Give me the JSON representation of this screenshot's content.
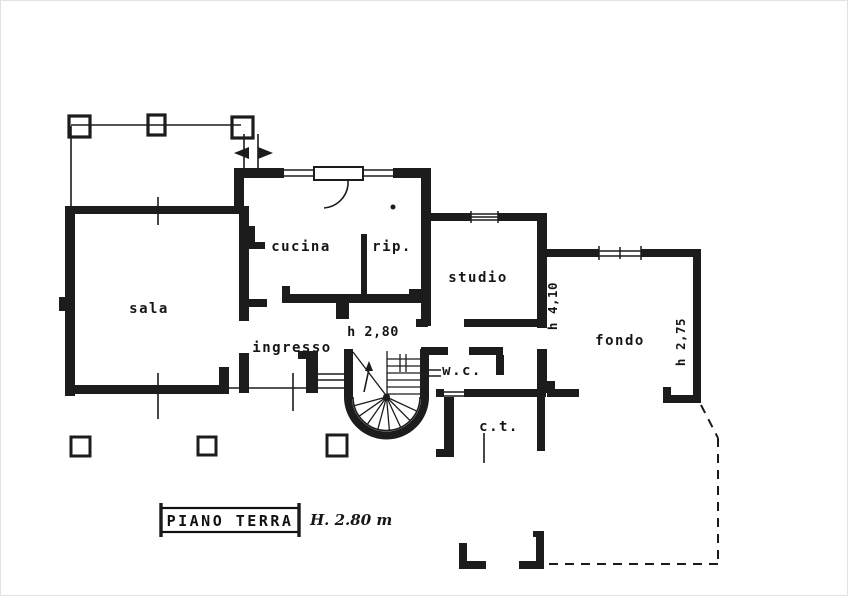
{
  "plan": {
    "type": "architectural floor plan (scanned black ink drawing)",
    "floor_label": "PIANO TERRA",
    "ceiling_height_note": "H. 2.80 m",
    "rooms": {
      "sala": {
        "label": "sala"
      },
      "cucina": {
        "label": "cucina"
      },
      "rip": {
        "label": "rip."
      },
      "studio": {
        "label": "studio"
      },
      "ingresso": {
        "label": "ingresso"
      },
      "fondo": {
        "label": "fondo"
      },
      "wc": {
        "label": "w.c."
      },
      "ct": {
        "label": "c.t."
      }
    },
    "height_annotations": {
      "corridor": {
        "label": "h 2,80"
      },
      "studio_fondo_wall": {
        "label": "h 4,10"
      },
      "fondo_right_wall": {
        "label": "h 2,75"
      }
    },
    "colors": {
      "ink": "#1c1c1c",
      "paper": "#ffffff"
    }
  }
}
